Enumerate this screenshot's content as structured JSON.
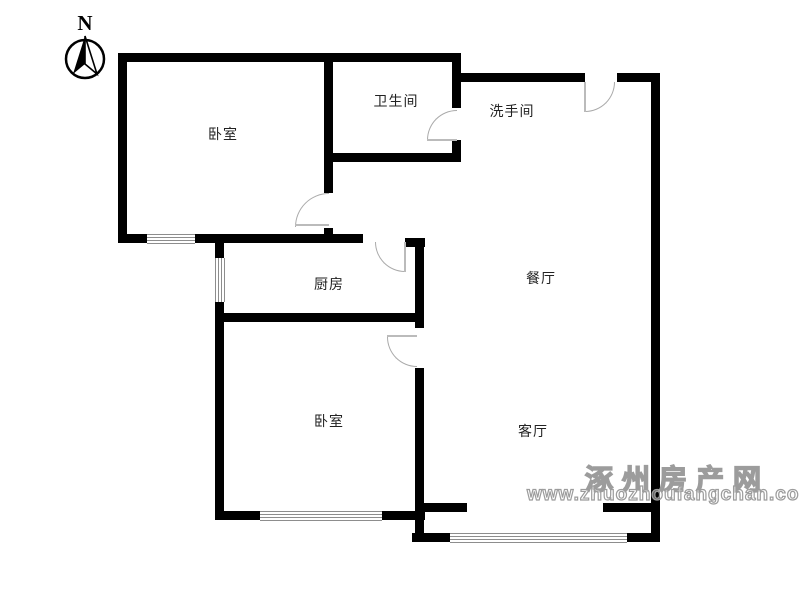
{
  "compass": {
    "label": "N"
  },
  "rooms": [
    {
      "name": "bedroom-1",
      "label": "卧室"
    },
    {
      "name": "bathroom",
      "label": "卫生间"
    },
    {
      "name": "washroom",
      "label": "洗手间"
    },
    {
      "name": "kitchen",
      "label": "厨房"
    },
    {
      "name": "dining-room",
      "label": "餐厅"
    },
    {
      "name": "bedroom-2",
      "label": "卧室"
    },
    {
      "name": "living-room",
      "label": "客厅"
    }
  ],
  "watermark": {
    "site_name": "涿州房产网",
    "site_url": "www.zhuozhoufangchan.com"
  },
  "colors": {
    "wall": "#000000",
    "door_arc": "#aaaaaa",
    "door_leaf": "#bbbbbb",
    "window_line": "#8d8d8d",
    "label_text": "#222222",
    "watermark": "#9c9c9c",
    "background": "#ffffff"
  }
}
